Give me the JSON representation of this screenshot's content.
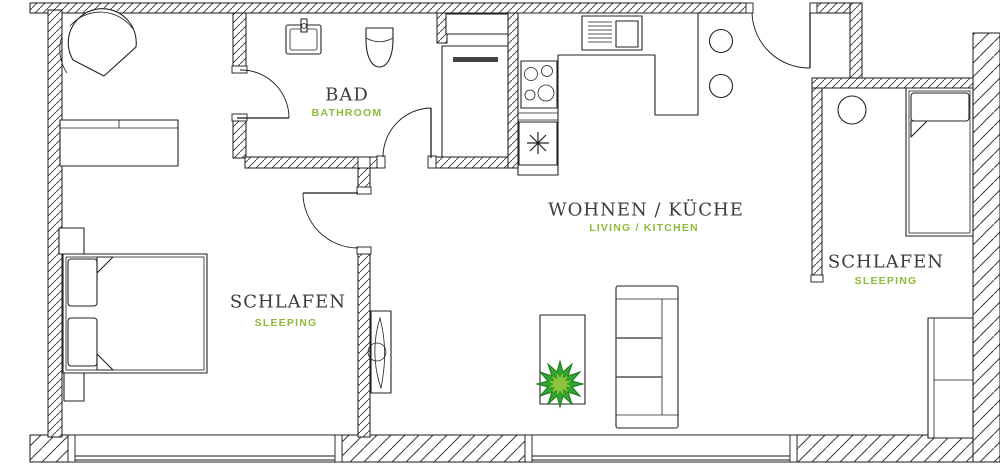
{
  "plan": {
    "kind": "apartment-floor-plan"
  },
  "colors": {
    "label": "#3b3b3b",
    "accent_green": "#8FBA3C",
    "wall_line": "#1a1a1a",
    "plant_outer": "#33A532",
    "plant_inner": "#8CC63F"
  },
  "rooms": {
    "bathroom": {
      "name": "BAD",
      "name_en": "BATHROOM"
    },
    "living_kitchen": {
      "name": "WOHNEN / KÜCHE",
      "name_en": "LIVING / KITCHEN"
    },
    "bedroom_left": {
      "name": "SCHLAFEN",
      "name_en": "SLEEPING"
    },
    "bedroom_right": {
      "name": "SCHLAFEN",
      "name_en": "SLEEPING"
    }
  }
}
